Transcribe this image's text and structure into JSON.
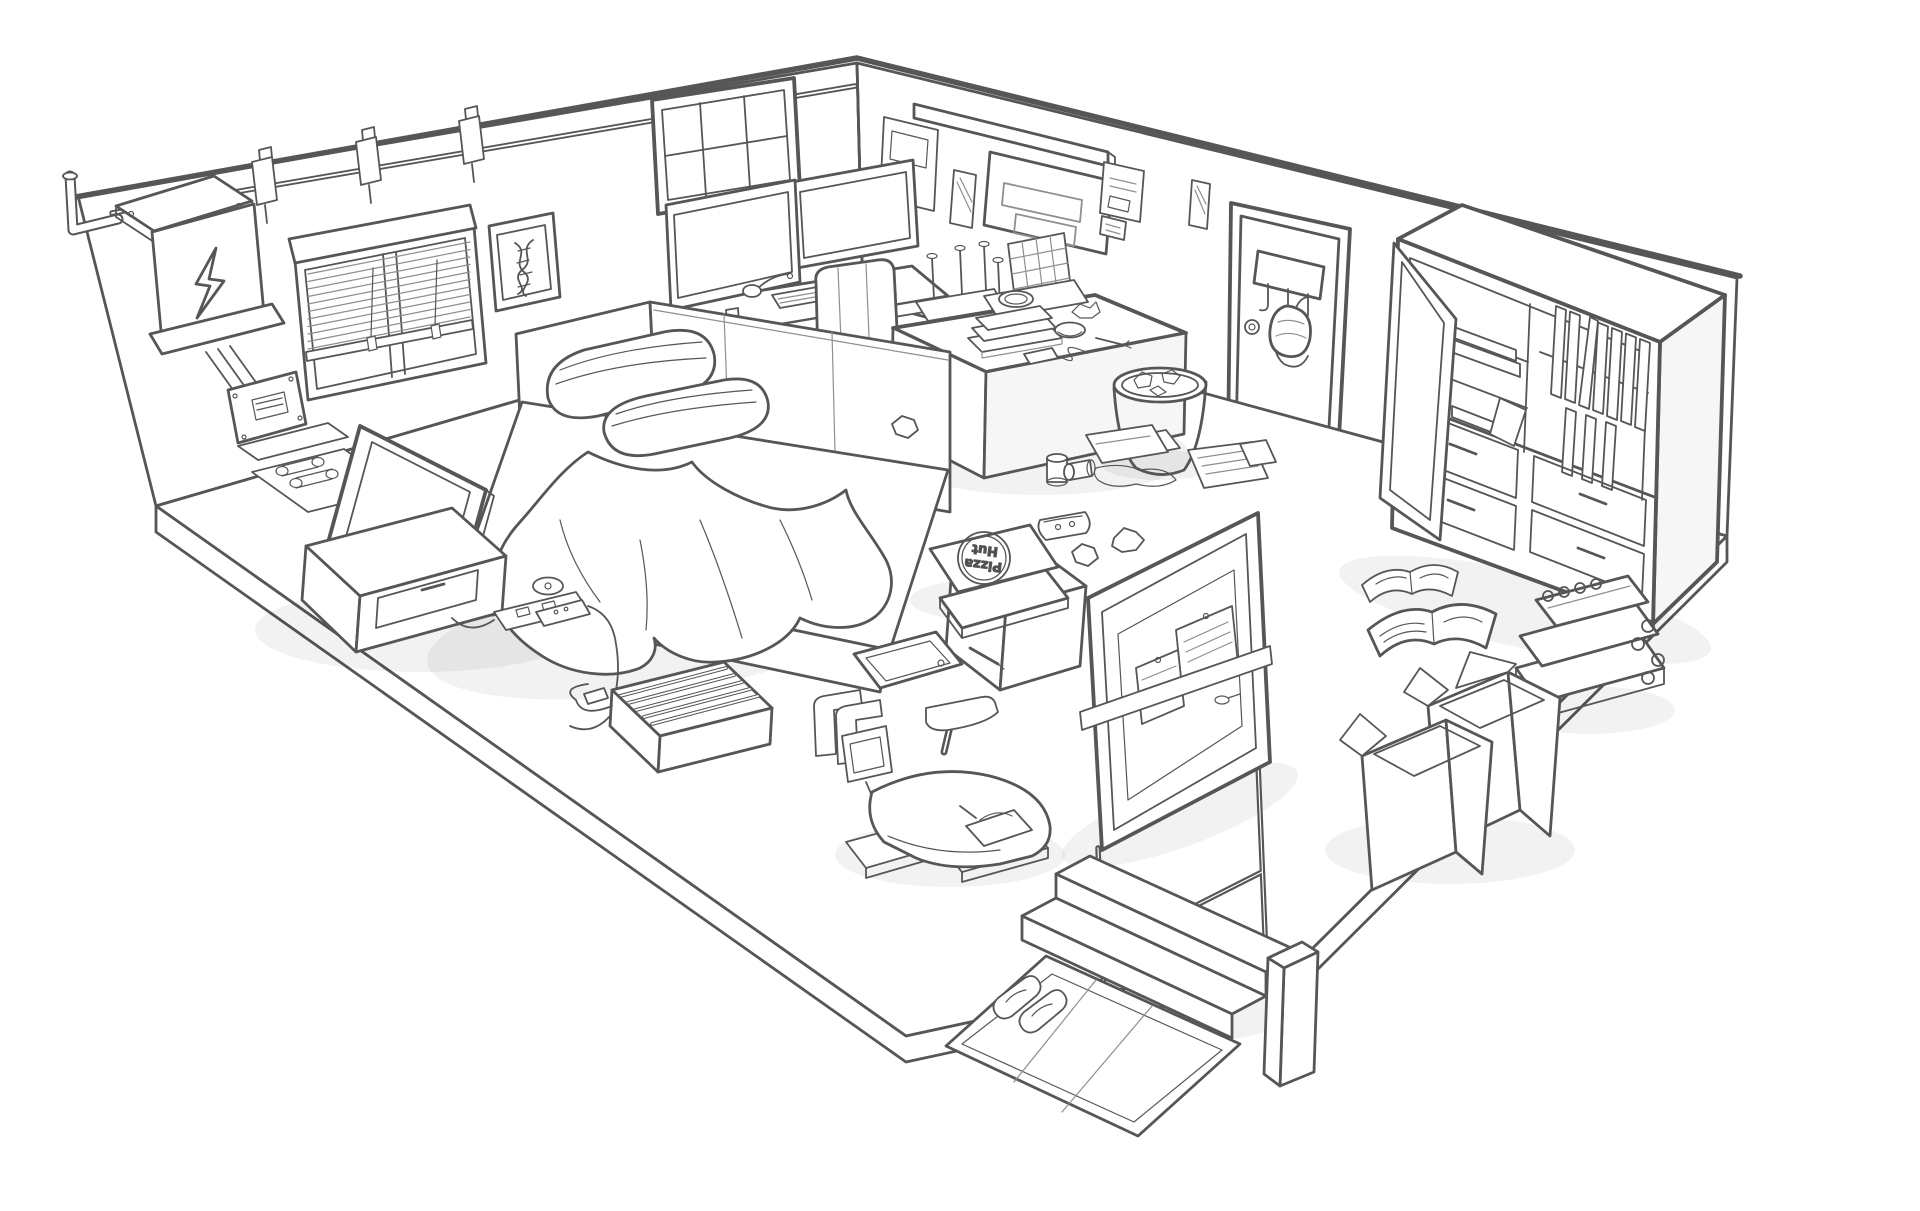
{
  "scene": {
    "title": "Hand-drawn isometric sketch of a cluttered studio room",
    "background_color": "#ffffff",
    "line_color": "#565656",
    "light_line_color": "#8f8f8f",
    "shade_opacity": 0.05
  },
  "pizza_box": {
    "line1": "Pizza",
    "line2": "Hut"
  },
  "objects": [
    "electrical-panel",
    "wall-pipe",
    "light-rail",
    "track-light",
    "window-blinds",
    "dna-picture-frame",
    "transom-window",
    "wall-posters",
    "pinned-notes",
    "door",
    "coat-hook-rack",
    "hanging-bag",
    "door-knob",
    "shelf-unit",
    "open-cabinet-door",
    "drawers",
    "workstation-desk",
    "dual-monitors",
    "keyboard",
    "mouse",
    "desk-mic",
    "office-chair",
    "upturned-stool",
    "dish-rack",
    "side-desk",
    "book-stack",
    "bowl",
    "fork",
    "phone",
    "trash-bin",
    "paper-sheet",
    "bed",
    "pillows",
    "blanket",
    "armrest-block",
    "display-case",
    "flatscreen-tv",
    "tv-cabinet",
    "power-strip",
    "space-heater",
    "cd-disc",
    "remote",
    "soda-cans",
    "loose-papers",
    "pizza-slice",
    "crumpled-paper",
    "pizza-box",
    "tablet",
    "stylus",
    "exercise-bike",
    "standing-pinboard",
    "open-books",
    "binder-stack",
    "cardboard-boxes",
    "entry-steps",
    "entry-mat",
    "slippers"
  ]
}
